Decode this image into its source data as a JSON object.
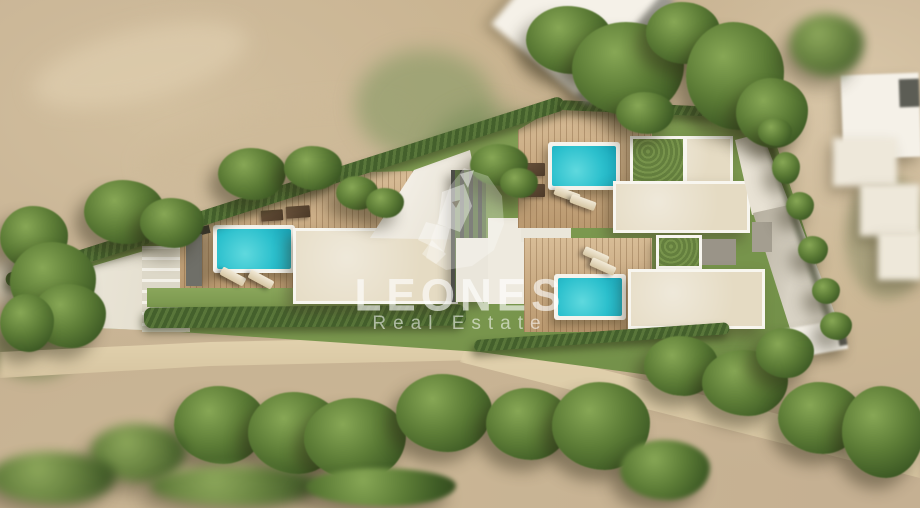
{
  "watermark": {
    "brand": "LEONES",
    "tagline": "Real Estate",
    "logo": "lion-head-icon",
    "text_color": "#ffffff"
  },
  "scene": {
    "kind": "aerial-architectural-render-of-villa-plot",
    "villas": [
      {
        "id": "villa-west",
        "features": [
          "swimming-pool",
          "wood-deck",
          "sun-loungers",
          "flat-roof",
          "pergola",
          "driveway"
        ]
      },
      {
        "id": "villa-northeast",
        "features": [
          "swimming-pool",
          "wood-deck",
          "sun-loungers",
          "green-roof",
          "flat-roof"
        ]
      },
      {
        "id": "villa-southeast",
        "features": [
          "swimming-pool",
          "wood-deck",
          "sun-loungers",
          "green-roof",
          "flat-roof",
          "lawn"
        ]
      }
    ],
    "palette": {
      "terrain_tan": "#c5b092",
      "pool_water": "#2cc0cd",
      "deck_wood": "#c9a87e",
      "lawn_green": "#7e9b51",
      "hedge_green": "#44602c",
      "roof_beige": "#e5dbc3",
      "pavement_white": "#edeadf",
      "pergola_gray": "#4e4f49"
    }
  }
}
